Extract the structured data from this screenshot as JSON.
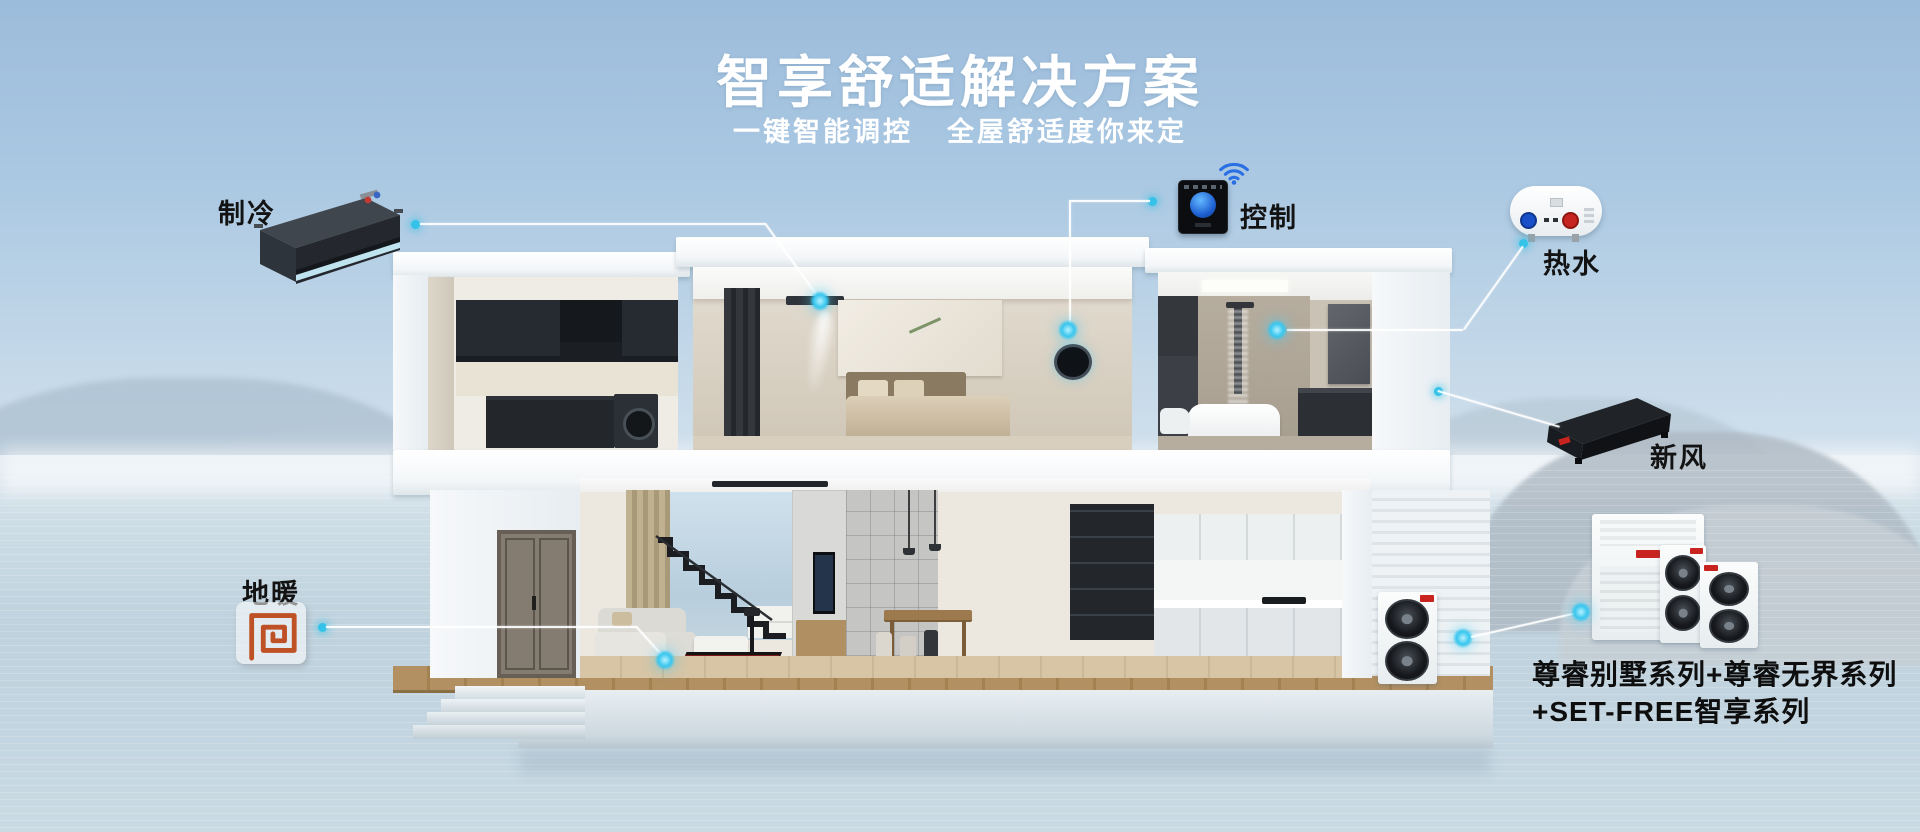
{
  "header": {
    "title": "智享舒适解决方案",
    "subtitle_left": "一键智能调控",
    "subtitle_right": "全屋舒适度你来定"
  },
  "callouts": {
    "cooling": {
      "label": "制冷",
      "product": "ducted-indoor-unit"
    },
    "control": {
      "label": "控制",
      "product": "smart-thermostat-panel",
      "icon": "wifi-icon"
    },
    "hot_water": {
      "label": "热水",
      "product": "storage-water-heater"
    },
    "fresh_air": {
      "label": "新风",
      "product": "fresh-air-ventilation-unit"
    },
    "floor_heating": {
      "label": "地暖",
      "icon": "floor-heating-coil-icon"
    }
  },
  "outdoor_units": {
    "caption_line1": "尊睿别墅系列+尊睿无界系列",
    "caption_line2": "+SET-FREE智享系列"
  },
  "colors": {
    "accent_cyan": "#35c2e8",
    "title_white": "#ffffff",
    "label_black": "#131313",
    "coil_orange": "#bf5127",
    "logo_red": "#c8231f",
    "sky_top": "#9cbcdb",
    "water": "#c3d5e0"
  },
  "icons": {
    "wifi": "wifi-icon",
    "heating_coil": "floor-heating-coil-icon",
    "hotspot": "hotspot-glow-dot"
  }
}
